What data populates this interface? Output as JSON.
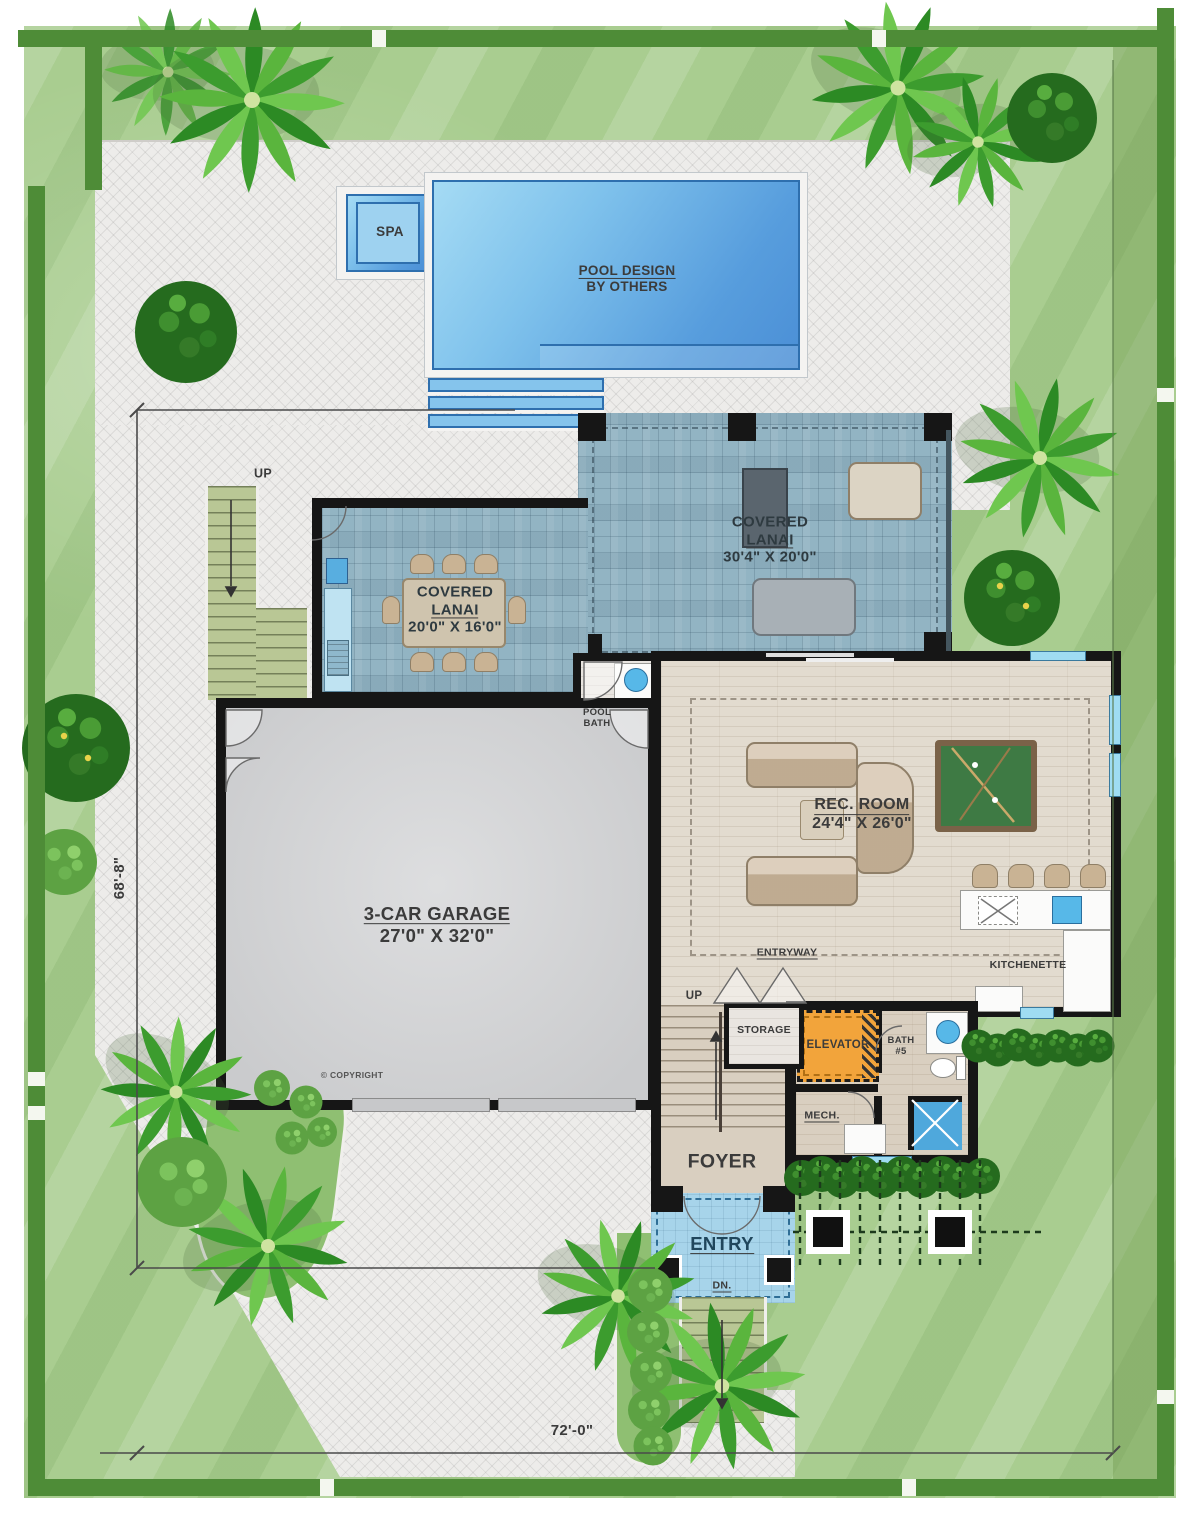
{
  "title": "single-family home first floor site plan",
  "labels": {
    "spa": "SPA",
    "pool_design_line1": "POOL DESIGN",
    "pool_design_line2": "BY OTHERS",
    "lanai_r_1": "COVERED",
    "lanai_r_2": "LANAI",
    "lanai_r_3": "30'4\" X 20'0\"",
    "lanai_l_1": "COVERED",
    "lanai_l_2": "LANAI",
    "lanai_l_3": "20'0\" X 16'0\"",
    "pool_bath_1": "POOL",
    "pool_bath_2": "BATH",
    "rec_1": "REC. ROOM",
    "rec_2": "24'4\" X 26'0\"",
    "garage_1": "3-CAR GARAGE",
    "garage_2": "27'0\" X 32'0\"",
    "entryway": "ENTRYWAY",
    "kitchenette": "KITCHENETTE",
    "storage": "STORAGE",
    "elevator": "ELEVATOR",
    "bath5_1": "BATH",
    "bath5_2": "#5",
    "mech": "MECH.",
    "foyer": "FOYER",
    "entry": "ENTRY",
    "dn": "DN.",
    "up_outdoor": "UP",
    "up_foyer": "UP",
    "copyright": "© COPYRIGHT",
    "dim_left": "68'-8\"",
    "dim_bottom": "72'-0\""
  },
  "colors": {
    "lawn_green": "#a9cd90",
    "property_line_green": "#4e8c37",
    "hardscape": "#edecea",
    "pool_water": "#579ddd",
    "spa_water": "#9ed2f0",
    "lanai_paver_blue": "#92b4c3",
    "wood_floor": "#e2dbcf",
    "garage_floor": "#d2d3d5",
    "wall_black": "#161616",
    "elevator_orange": "#f2a43b",
    "entry_tile_blue": "#a7d4ea",
    "outdoor_stair_green": "#b9c795",
    "label_text": "#3b3b3b"
  }
}
